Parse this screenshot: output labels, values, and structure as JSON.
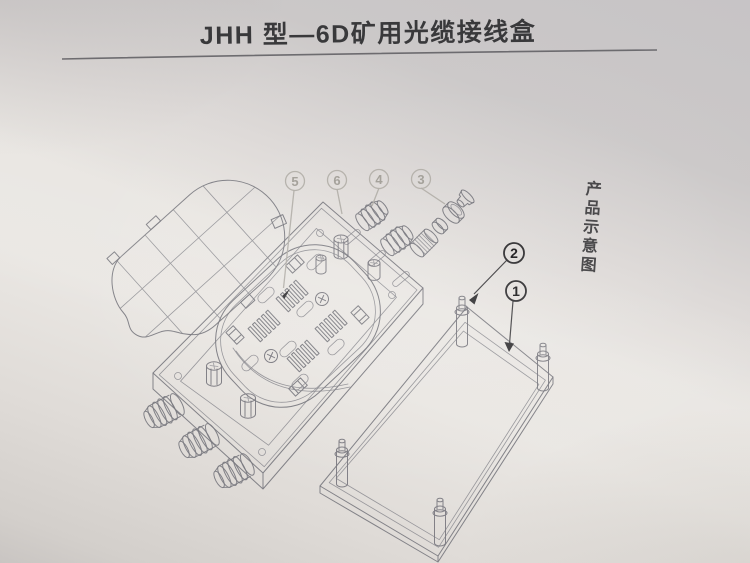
{
  "page": {
    "title": "JHH 型—6D矿用光缆接线盒",
    "side_caption": "产品示意图"
  },
  "diagram": {
    "type": "exploded-view-line-drawing",
    "callouts": [
      {
        "label": "5",
        "style": "light"
      },
      {
        "label": "6",
        "style": "light"
      },
      {
        "label": "4",
        "style": "light"
      },
      {
        "label": "3",
        "style": "light"
      },
      {
        "label": "2",
        "style": "dark"
      },
      {
        "label": "1",
        "style": "dark"
      }
    ]
  },
  "colors": {
    "paper_top": "#c7c4c6",
    "paper_mid": "#e9e6e3",
    "paper_bottom": "#c9c5c2",
    "drawing_line": "#7a7980",
    "light_callout": "#b3b0aa",
    "dark_ink": "#39383a",
    "title_ink": "#39393b"
  }
}
